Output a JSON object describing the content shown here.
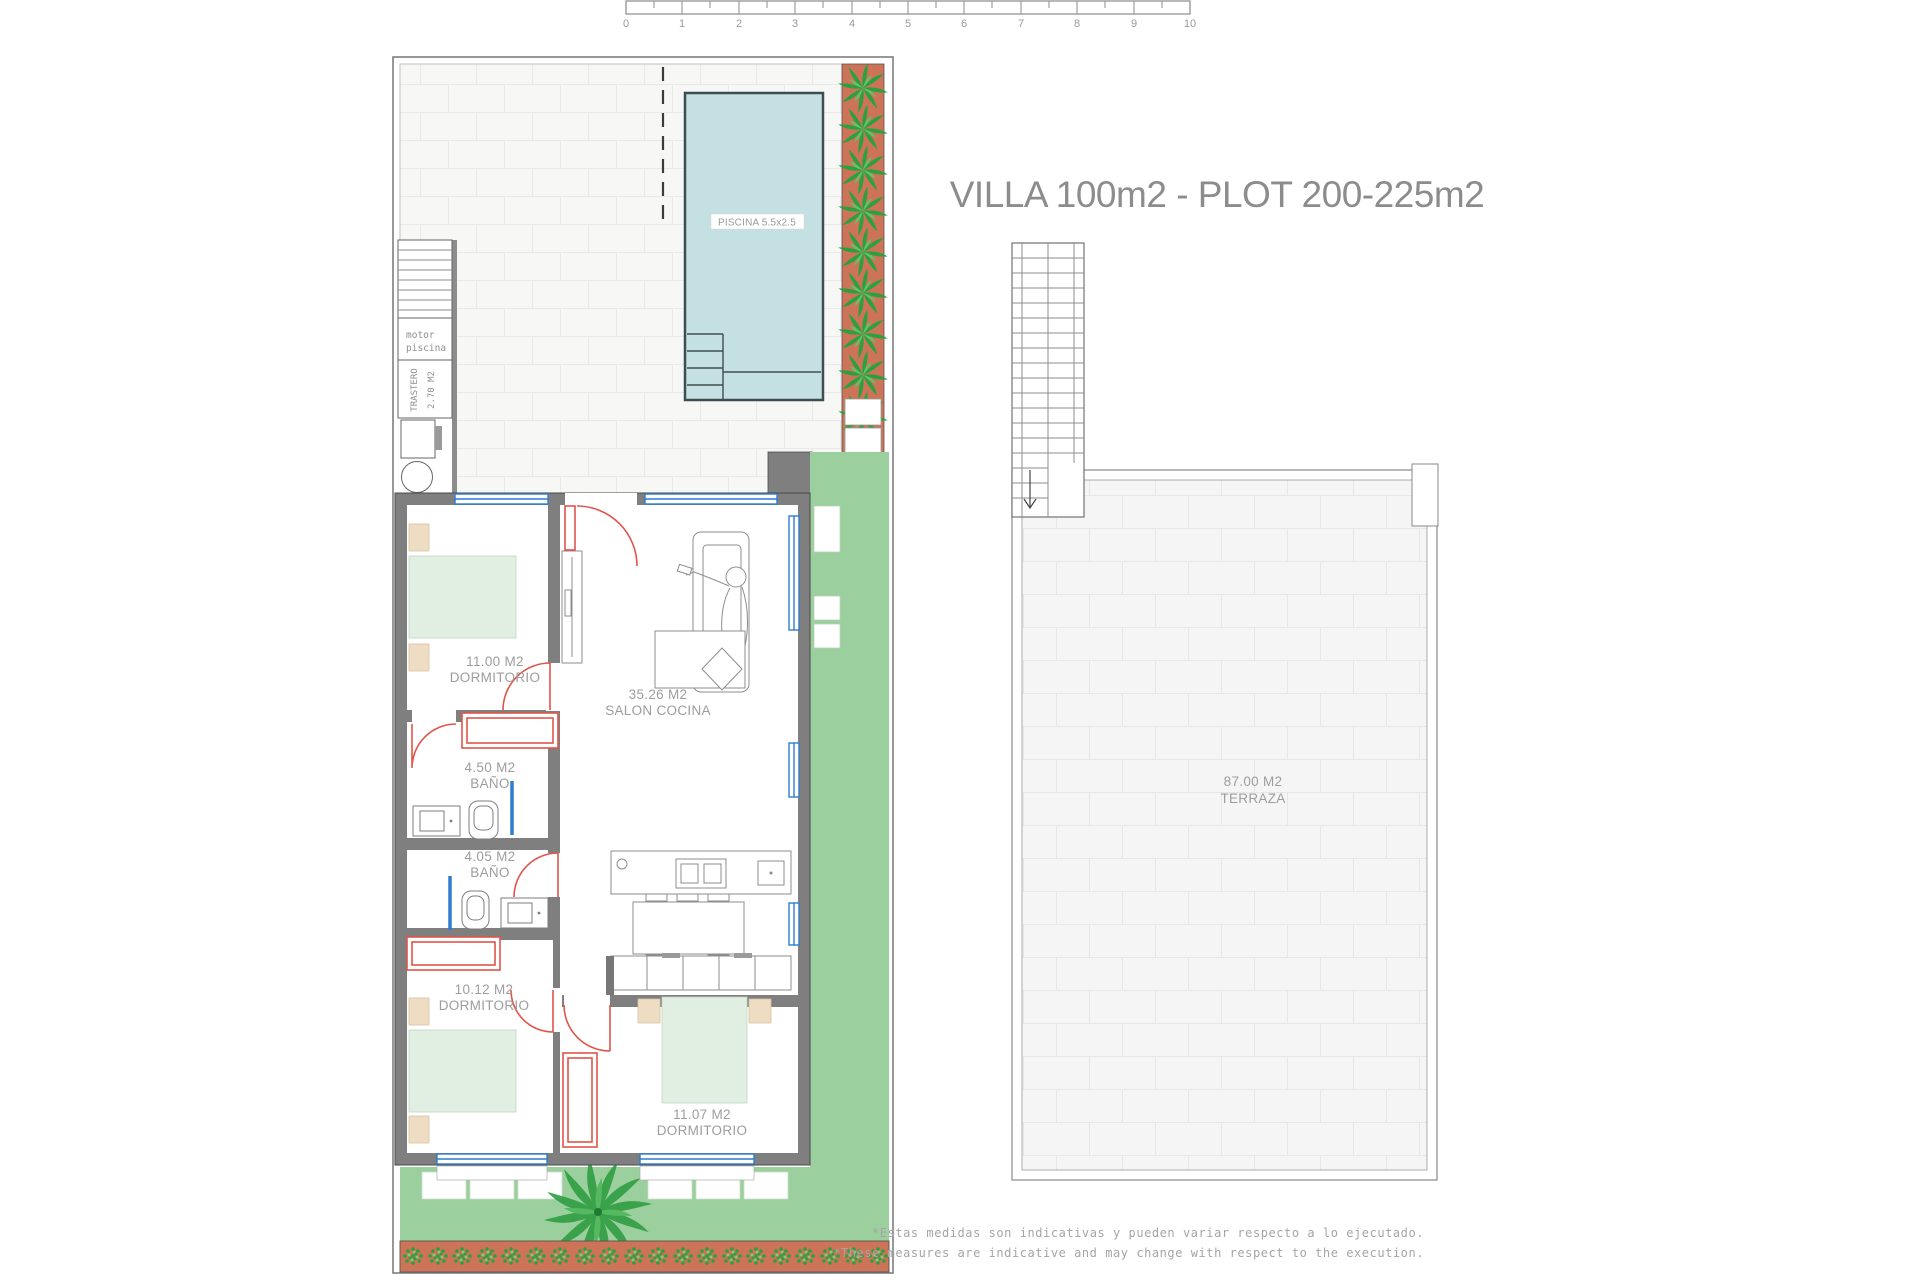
{
  "title": "VILLA 100m2 - PLOT 200-225m2",
  "scale_bar": {
    "labels": [
      "0",
      "1",
      "2",
      "3",
      "4",
      "5",
      "6",
      "7",
      "8",
      "9",
      "10"
    ]
  },
  "ground_floor": {
    "pool": {
      "label": "PISCINA 5.5x2.5"
    },
    "pool_motor_room": {
      "line1": "motor",
      "line2": "piscina"
    },
    "storage": {
      "name": "TRASTERO",
      "area": "2.70 M2"
    },
    "rooms": {
      "bedroom1": {
        "area": "11.00 M2",
        "name": "DORMITORIO"
      },
      "salon": {
        "area": "35.26 M2",
        "name": "SALON COCINA"
      },
      "bath1": {
        "area": "4.50 M2",
        "name": "BAÑO"
      },
      "bath2": {
        "area": "4.05 M2",
        "name": "BAÑO"
      },
      "bedroom2": {
        "area": "10.12 M2",
        "name": "DORMITORIO"
      },
      "bedroom3": {
        "area": "11.07 M2",
        "name": "DORMITORIO"
      }
    }
  },
  "roof": {
    "terrace": {
      "area": "87.00 M2",
      "name": "TERRAZA"
    }
  },
  "disclaimer": {
    "es": "*Estas medidas son indicativas y pueden variar respecto a lo ejecutado.",
    "en": "*These measures are indicative and may change with respect to the execution."
  },
  "colors": {
    "pool": "#c5e0e3",
    "garden": "#9bcf9d",
    "planter": "#cd7458",
    "plant": "#2aa13c",
    "wall": "#7f7f7f",
    "window": "#2f7cd0",
    "door": "#e0554a",
    "bed": "#e1eee2",
    "pillow": "#eedcc3",
    "label": "#9d9d9d",
    "title": "#8c8c8c"
  }
}
